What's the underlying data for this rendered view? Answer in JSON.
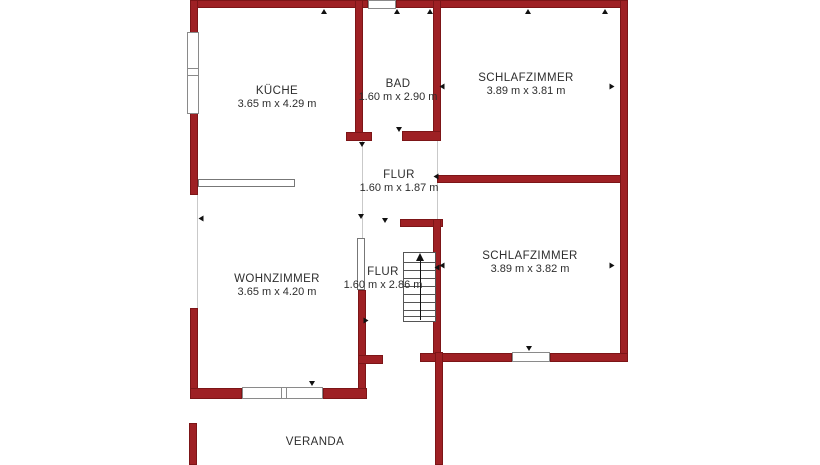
{
  "colors": {
    "wall_fill": "#9E2024",
    "wall_border": "#7C1517",
    "text": "#2e2e2e",
    "window_border": "#8a8a8a",
    "faint_line": "#c9c9c9",
    "stairs_line": "#555555",
    "marker": "#111111"
  },
  "rooms": {
    "kueche": {
      "label": "KÜCHE",
      "dims": "3.65 m x 4.29 m"
    },
    "bad": {
      "label": "BAD",
      "dims": "1.60 m x 2.90 m"
    },
    "schlafzimmer1": {
      "label": "SCHLAFZIMMER",
      "dims": "3.89 m x 3.81 m"
    },
    "flur1": {
      "label": "FLUR",
      "dims": "1.60 m x 1.87 m"
    },
    "wohnzimmer": {
      "label": "WOHNZIMMER",
      "dims": "3.65 m x 4.20 m"
    },
    "flur2": {
      "label": "FLUR",
      "dims": "1.60 m x 2.86 m"
    },
    "schlafzimmer2": {
      "label": "SCHLAFZIMMER",
      "dims": "3.89 m x 3.82 m"
    },
    "veranda": {
      "label": "VERANDA",
      "dims": ""
    }
  },
  "plan": {
    "walls": [
      {
        "name": "wall-exterior-top-left",
        "r": [
          190,
          0,
          178,
          8
        ]
      },
      {
        "name": "wall-exterior-top-right",
        "r": [
          396,
          0,
          232,
          8
        ]
      },
      {
        "name": "wall-exterior-left-upper",
        "r": [
          190,
          0,
          8,
          33
        ]
      },
      {
        "name": "wall-exterior-left-mid",
        "r": [
          190,
          113,
          8,
          82
        ]
      },
      {
        "name": "wall-exterior-left-lower",
        "r": [
          190,
          308,
          8,
          91
        ]
      },
      {
        "name": "wall-kueche-bad",
        "r": [
          355,
          0,
          8,
          133
        ]
      },
      {
        "name": "wall-bad-door-stub",
        "r": [
          346,
          132,
          26,
          9
        ]
      },
      {
        "name": "wall-bad-bottom",
        "r": [
          402,
          131,
          39,
          10
        ]
      },
      {
        "name": "wall-bad-schlafzimmer",
        "r": [
          433,
          0,
          8,
          132
        ]
      },
      {
        "name": "wall-schlafzimmer-divider",
        "r": [
          437,
          175,
          191,
          8
        ]
      },
      {
        "name": "wall-exterior-right",
        "r": [
          620,
          0,
          8,
          362
        ]
      },
      {
        "name": "wall-stairwell-top-stub",
        "r": [
          400,
          219,
          43,
          8
        ]
      },
      {
        "name": "wall-flur-schlafzimmer2",
        "r": [
          433,
          219,
          8,
          143
        ]
      },
      {
        "name": "wall-schlafzimmer2-bottom-l",
        "r": [
          420,
          353,
          92,
          9
        ]
      },
      {
        "name": "wall-schlafzimmer2-bottom-r",
        "r": [
          550,
          353,
          78,
          9
        ]
      },
      {
        "name": "wall-wohnzimmer-flur",
        "r": [
          358,
          290,
          8,
          109
        ]
      },
      {
        "name": "wall-flur-door-stub",
        "r": [
          358,
          355,
          25,
          9
        ]
      },
      {
        "name": "wall-wohnzimmer-bottom-l",
        "r": [
          190,
          388,
          52,
          11
        ]
      },
      {
        "name": "wall-wohnzimmer-bottom-r",
        "r": [
          323,
          388,
          44,
          11
        ]
      },
      {
        "name": "wall-veranda-left",
        "r": [
          189,
          423,
          8,
          42
        ]
      },
      {
        "name": "wall-veranda-right",
        "r": [
          435,
          352,
          8,
          113
        ]
      }
    ],
    "windows": [
      {
        "name": "window-kueche",
        "r": [
          187,
          32,
          12,
          82
        ]
      },
      {
        "name": "window-bad",
        "r": [
          368,
          0,
          28,
          9
        ]
      },
      {
        "name": "window-wohnzimmer",
        "r": [
          242,
          387,
          81,
          12
        ]
      },
      {
        "name": "window-schlafzimmer2",
        "r": [
          512,
          352,
          38,
          10
        ]
      }
    ],
    "window_lines": [
      [
        188,
        68,
        11,
        1
      ],
      [
        188,
        75,
        11,
        1
      ],
      [
        281,
        388,
        1,
        10
      ],
      [
        286,
        388,
        1,
        10
      ]
    ],
    "faint_lines": [
      [
        197,
        195,
        1,
        113
      ],
      [
        437,
        141,
        1,
        34
      ],
      [
        437,
        183,
        1,
        36
      ],
      [
        362,
        141,
        1,
        99
      ]
    ],
    "furniture": [
      {
        "name": "kitchen-counter",
        "r": [
          198,
          179,
          97,
          8
        ]
      },
      {
        "name": "door-leaf",
        "r": [
          357,
          238,
          8,
          52
        ]
      }
    ],
    "stairs": {
      "rect": [
        403,
        252,
        33,
        70
      ],
      "tread_ys": [
        9,
        17,
        25,
        33,
        41,
        49,
        57,
        63
      ],
      "arrow_x": 420,
      "arrow_top": 253,
      "arrow_bottom": 320
    },
    "markers": [
      {
        "x": 324,
        "y": 9,
        "d": "up"
      },
      {
        "x": 397,
        "y": 9,
        "d": "up"
      },
      {
        "x": 430,
        "y": 9,
        "d": "up"
      },
      {
        "x": 528,
        "y": 9,
        "d": "up"
      },
      {
        "x": 605,
        "y": 9,
        "d": "up"
      },
      {
        "x": 312,
        "y": 381,
        "d": "down"
      },
      {
        "x": 529,
        "y": 346,
        "d": "down"
      },
      {
        "x": 399,
        "y": 127,
        "d": "down"
      },
      {
        "x": 362,
        "y": 142,
        "d": "down"
      },
      {
        "x": 385,
        "y": 218,
        "d": "down"
      },
      {
        "x": 361,
        "y": 214,
        "d": "down"
      },
      {
        "x": 442,
        "y": 84,
        "d": "left"
      },
      {
        "x": 442,
        "y": 263,
        "d": "left"
      },
      {
        "x": 436,
        "y": 174,
        "d": "left"
      },
      {
        "x": 437,
        "y": 265,
        "d": "left"
      },
      {
        "x": 201,
        "y": 216,
        "d": "left"
      },
      {
        "x": 612,
        "y": 84,
        "d": "right"
      },
      {
        "x": 612,
        "y": 263,
        "d": "right"
      },
      {
        "x": 366,
        "y": 318,
        "d": "right"
      }
    ]
  }
}
